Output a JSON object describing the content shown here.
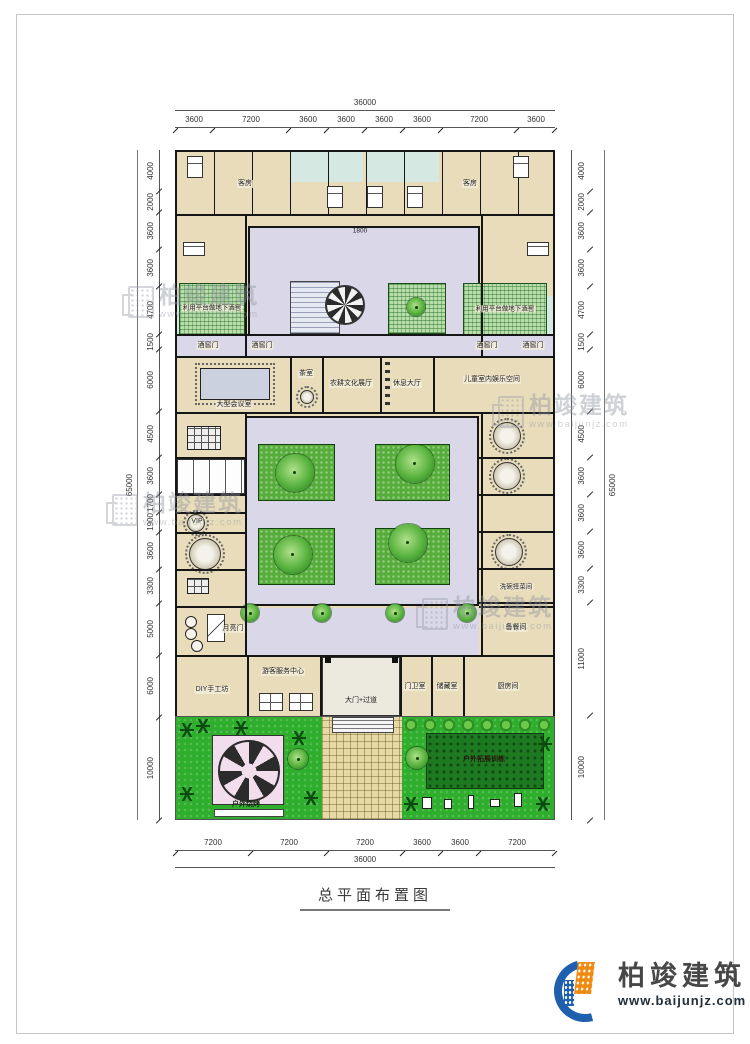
{
  "caption": "总平面布置图",
  "logo": {
    "name": "柏竣建筑",
    "url": "www.baijunjz.com"
  },
  "watermark": {
    "text": "柏竣建筑",
    "url": "www.baijunjz.com"
  },
  "dimensions": {
    "top": {
      "total": "36000",
      "segments": [
        "3600",
        "7200",
        "3600",
        "3600",
        "3600",
        "3600",
        "7200",
        "3600"
      ]
    },
    "bottom": {
      "total": "36000",
      "segments": [
        "7200",
        "7200",
        "7200",
        "3600",
        "3600",
        "7200"
      ]
    },
    "left": {
      "total": "65000",
      "segments": [
        "4000",
        "2000",
        "3600",
        "3600",
        "4700",
        "1500",
        "6000",
        "4500",
        "3600",
        "1700",
        "1900",
        "3600",
        "3300",
        "5000",
        "6000",
        "10000"
      ]
    },
    "right": {
      "total": "65000",
      "segments": [
        "4000",
        "2000",
        "3600",
        "3600",
        "4700",
        "1500",
        "6000",
        "4500",
        "3600",
        "3600",
        "3600",
        "3300",
        "11000",
        "10000"
      ]
    },
    "entry": "1800"
  },
  "rooms": {
    "guest": "客房",
    "platform_cellar": "利用平台做地下酒窖",
    "cellar_door": "酒窖门",
    "conference": "大型会议室",
    "tea": "茶室",
    "farming_hall": "农耕文化展厅",
    "rest_hall": "休息大厅",
    "kids": "儿童室内娱乐空间",
    "vip": "VIP",
    "moon_gate": "月亮门",
    "dishwash": "洗碗择菜间",
    "meal_prep": "备餐间",
    "diy": "DIY手工坊",
    "visitor_center": "游客服务中心",
    "gate": "大门+过道",
    "guard": "门卫室",
    "storage": "储藏室",
    "kitchen": "厨房间",
    "bbq": "户外烧烤",
    "outdoor_training": "户外拓展训练"
  }
}
